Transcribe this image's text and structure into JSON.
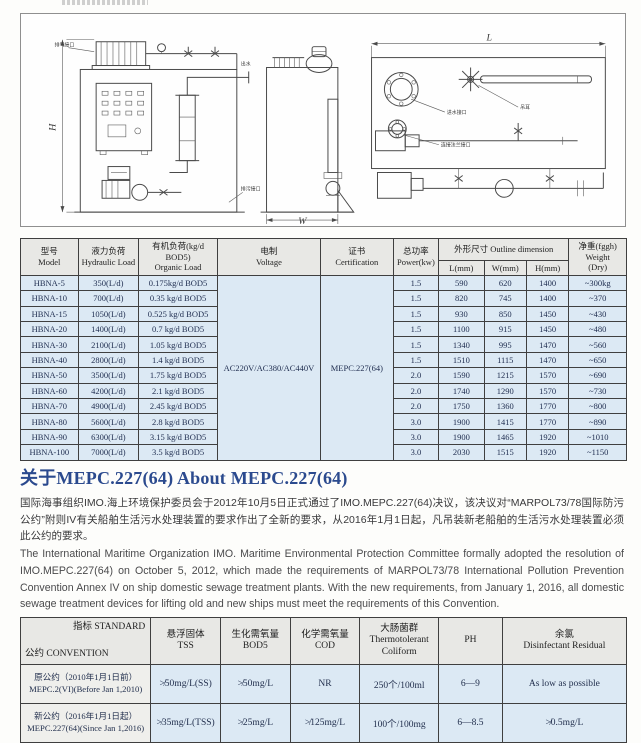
{
  "colors": {
    "accent_heading": "#2b4a8e",
    "table_body_bg": "#dce9f4",
    "table_header_bg": "#e8e8e5",
    "border": "#3f3f3f"
  },
  "diagram": {
    "dims": {
      "h": "H",
      "w": "W",
      "l": "L"
    },
    "labels": {
      "vent": "排气接口",
      "outlet": "出水",
      "drain": "排污接口",
      "inlet": "进水接口",
      "lifting": "吊耳",
      "flange": "连接法兰接口"
    }
  },
  "spec_table": {
    "headers": {
      "model_zh": "型号",
      "model_en": "Model",
      "hydraulic_zh": "液力负荷",
      "hydraulic_en": "Hydraulic Load",
      "organic_zh": "有机负荷(kg/d BOD5)",
      "organic_en": "Organic Load",
      "voltage_zh": "电制",
      "voltage_en": "Voltage",
      "cert_zh": "证书",
      "cert_en": "Certification",
      "power_zh": "总功率",
      "power_en": "Power(kw)",
      "outline": "外形尺寸 Outline dimension",
      "l": "L(mm)",
      "w": "W(mm)",
      "h": "H(mm)",
      "weight_zh": "净重(fggh)",
      "weight_en": "Weight",
      "weight_en2": "(Dry)"
    },
    "voltage_value": "AC220V/AC380/AC440V",
    "certification_value": "MEPC.227(64)",
    "rows": [
      {
        "model": "HBNA-5",
        "hydraulic": "350(L/d)",
        "organic": "0.175kg/d BOD5",
        "power": "1.5",
        "l": "590",
        "w": "620",
        "h": "1400",
        "weight": "~300kg"
      },
      {
        "model": "HBNA-10",
        "hydraulic": "700(L/d)",
        "organic": "0.35 kg/d BOD5",
        "power": "1.5",
        "l": "820",
        "w": "745",
        "h": "1400",
        "weight": "~370"
      },
      {
        "model": "HBNA-15",
        "hydraulic": "1050(L/d)",
        "organic": "0.525 kg/d BOD5",
        "power": "1.5",
        "l": "930",
        "w": "850",
        "h": "1450",
        "weight": "~430"
      },
      {
        "model": "HBNA-20",
        "hydraulic": "1400(L/d)",
        "organic": "0.7 kg/d BOD5",
        "power": "1.5",
        "l": "1100",
        "w": "915",
        "h": "1450",
        "weight": "~480"
      },
      {
        "model": "HBNA-30",
        "hydraulic": "2100(L/d)",
        "organic": "1.05 kg/d BOD5",
        "power": "1.5",
        "l": "1340",
        "w": "995",
        "h": "1470",
        "weight": "~560"
      },
      {
        "model": "HBNA-40",
        "hydraulic": "2800(L/d)",
        "organic": "1.4 kg/d BOD5",
        "power": "1.5",
        "l": "1510",
        "w": "1115",
        "h": "1470",
        "weight": "~650"
      },
      {
        "model": "HBNA-50",
        "hydraulic": "3500(L/d)",
        "organic": "1.75 kg/d BOD5",
        "power": "2.0",
        "l": "1590",
        "w": "1215",
        "h": "1570",
        "weight": "~690"
      },
      {
        "model": "HBNA-60",
        "hydraulic": "4200(L/d)",
        "organic": "2.1 kg/d BOD5",
        "power": "2.0",
        "l": "1740",
        "w": "1290",
        "h": "1570",
        "weight": "~730"
      },
      {
        "model": "HBNA-70",
        "hydraulic": "4900(L/d)",
        "organic": "2.45 kg/d BOD5",
        "power": "2.0",
        "l": "1750",
        "w": "1360",
        "h": "1770",
        "weight": "~800"
      },
      {
        "model": "HBNA-80",
        "hydraulic": "5600(L/d)",
        "organic": "2.8 kg/d BOD5",
        "power": "3.0",
        "l": "1900",
        "w": "1415",
        "h": "1770",
        "weight": "~890"
      },
      {
        "model": "HBNA-90",
        "hydraulic": "6300(L/d)",
        "organic": "3.15 kg/d BOD5",
        "power": "3.0",
        "l": "1900",
        "w": "1465",
        "h": "1920",
        "weight": "~1010"
      },
      {
        "model": "HBNA-100",
        "hydraulic": "7000(L/d)",
        "organic": "3.5 kg/d BOD5",
        "power": "3.0",
        "l": "2030",
        "w": "1515",
        "h": "1920",
        "weight": "~1150"
      }
    ]
  },
  "about": {
    "heading": "关于MEPC.227(64)  About MEPC.227(64)",
    "para_zh": "国际海事组织IMO.海上环境保护委员会于2012年10月5日正式通过了IMO.MEPC.227(64)决议，该决议对“MARPOL73/78国际防污公约”附则IV有关船舶生活污水处理装置的要求作出了全新的要求，从2016年1月1日起，凡吊装新老船舶的生活污水处理装置必须此公约的要求。",
    "para_en": "The International Maritime Organization IMO. Maritime Environmental Protection Committee formally adopted the resolution of IMO.MEPC.227(64) on October 5, 2012, which made the requirements of MARPOL73/78 International Pollution Prevention Convention Annex IV on ship domestic sewage treatment plants. With the new requirements, from January 1, 2016, all domestic sewage treatment devices for lifting old and new ships must meet the requirements of this Convention."
  },
  "standard_table": {
    "corner_top": "指标 STANDARD",
    "corner_bottom": "公约 CONVENTION",
    "columns": [
      {
        "zh": "悬浮固体",
        "en": "TSS"
      },
      {
        "zh": "生化需氧量",
        "en": "BOD5"
      },
      {
        "zh": "化学需氧量",
        "en": "COD"
      },
      {
        "zh": "大肠菌群",
        "en": "Thermotolerant Coliform"
      },
      {
        "zh": null,
        "en": "PH"
      },
      {
        "zh": "余氯",
        "en": "Disinfectant Residual"
      }
    ],
    "rows": [
      {
        "label_zh": "原公约（2010年1月1日前）",
        "label_en": "MEPC.2(VI)(Before Jan 1,2010)",
        "values": [
          "≯50mg/L(SS)",
          "≯50mg/L",
          "NR",
          "250个/100ml",
          "6—9",
          "As low as possible"
        ]
      },
      {
        "label_zh": "新公约（2016年1月1日起）",
        "label_en": "MEPC.227(64)(Since Jan 1,2016)",
        "values": [
          "≯35mg/L(TSS)",
          "≯25mg/L",
          "≯125mg/L",
          "100个/100mg",
          "6—8.5",
          "≯0.5mg/L"
        ]
      }
    ]
  }
}
